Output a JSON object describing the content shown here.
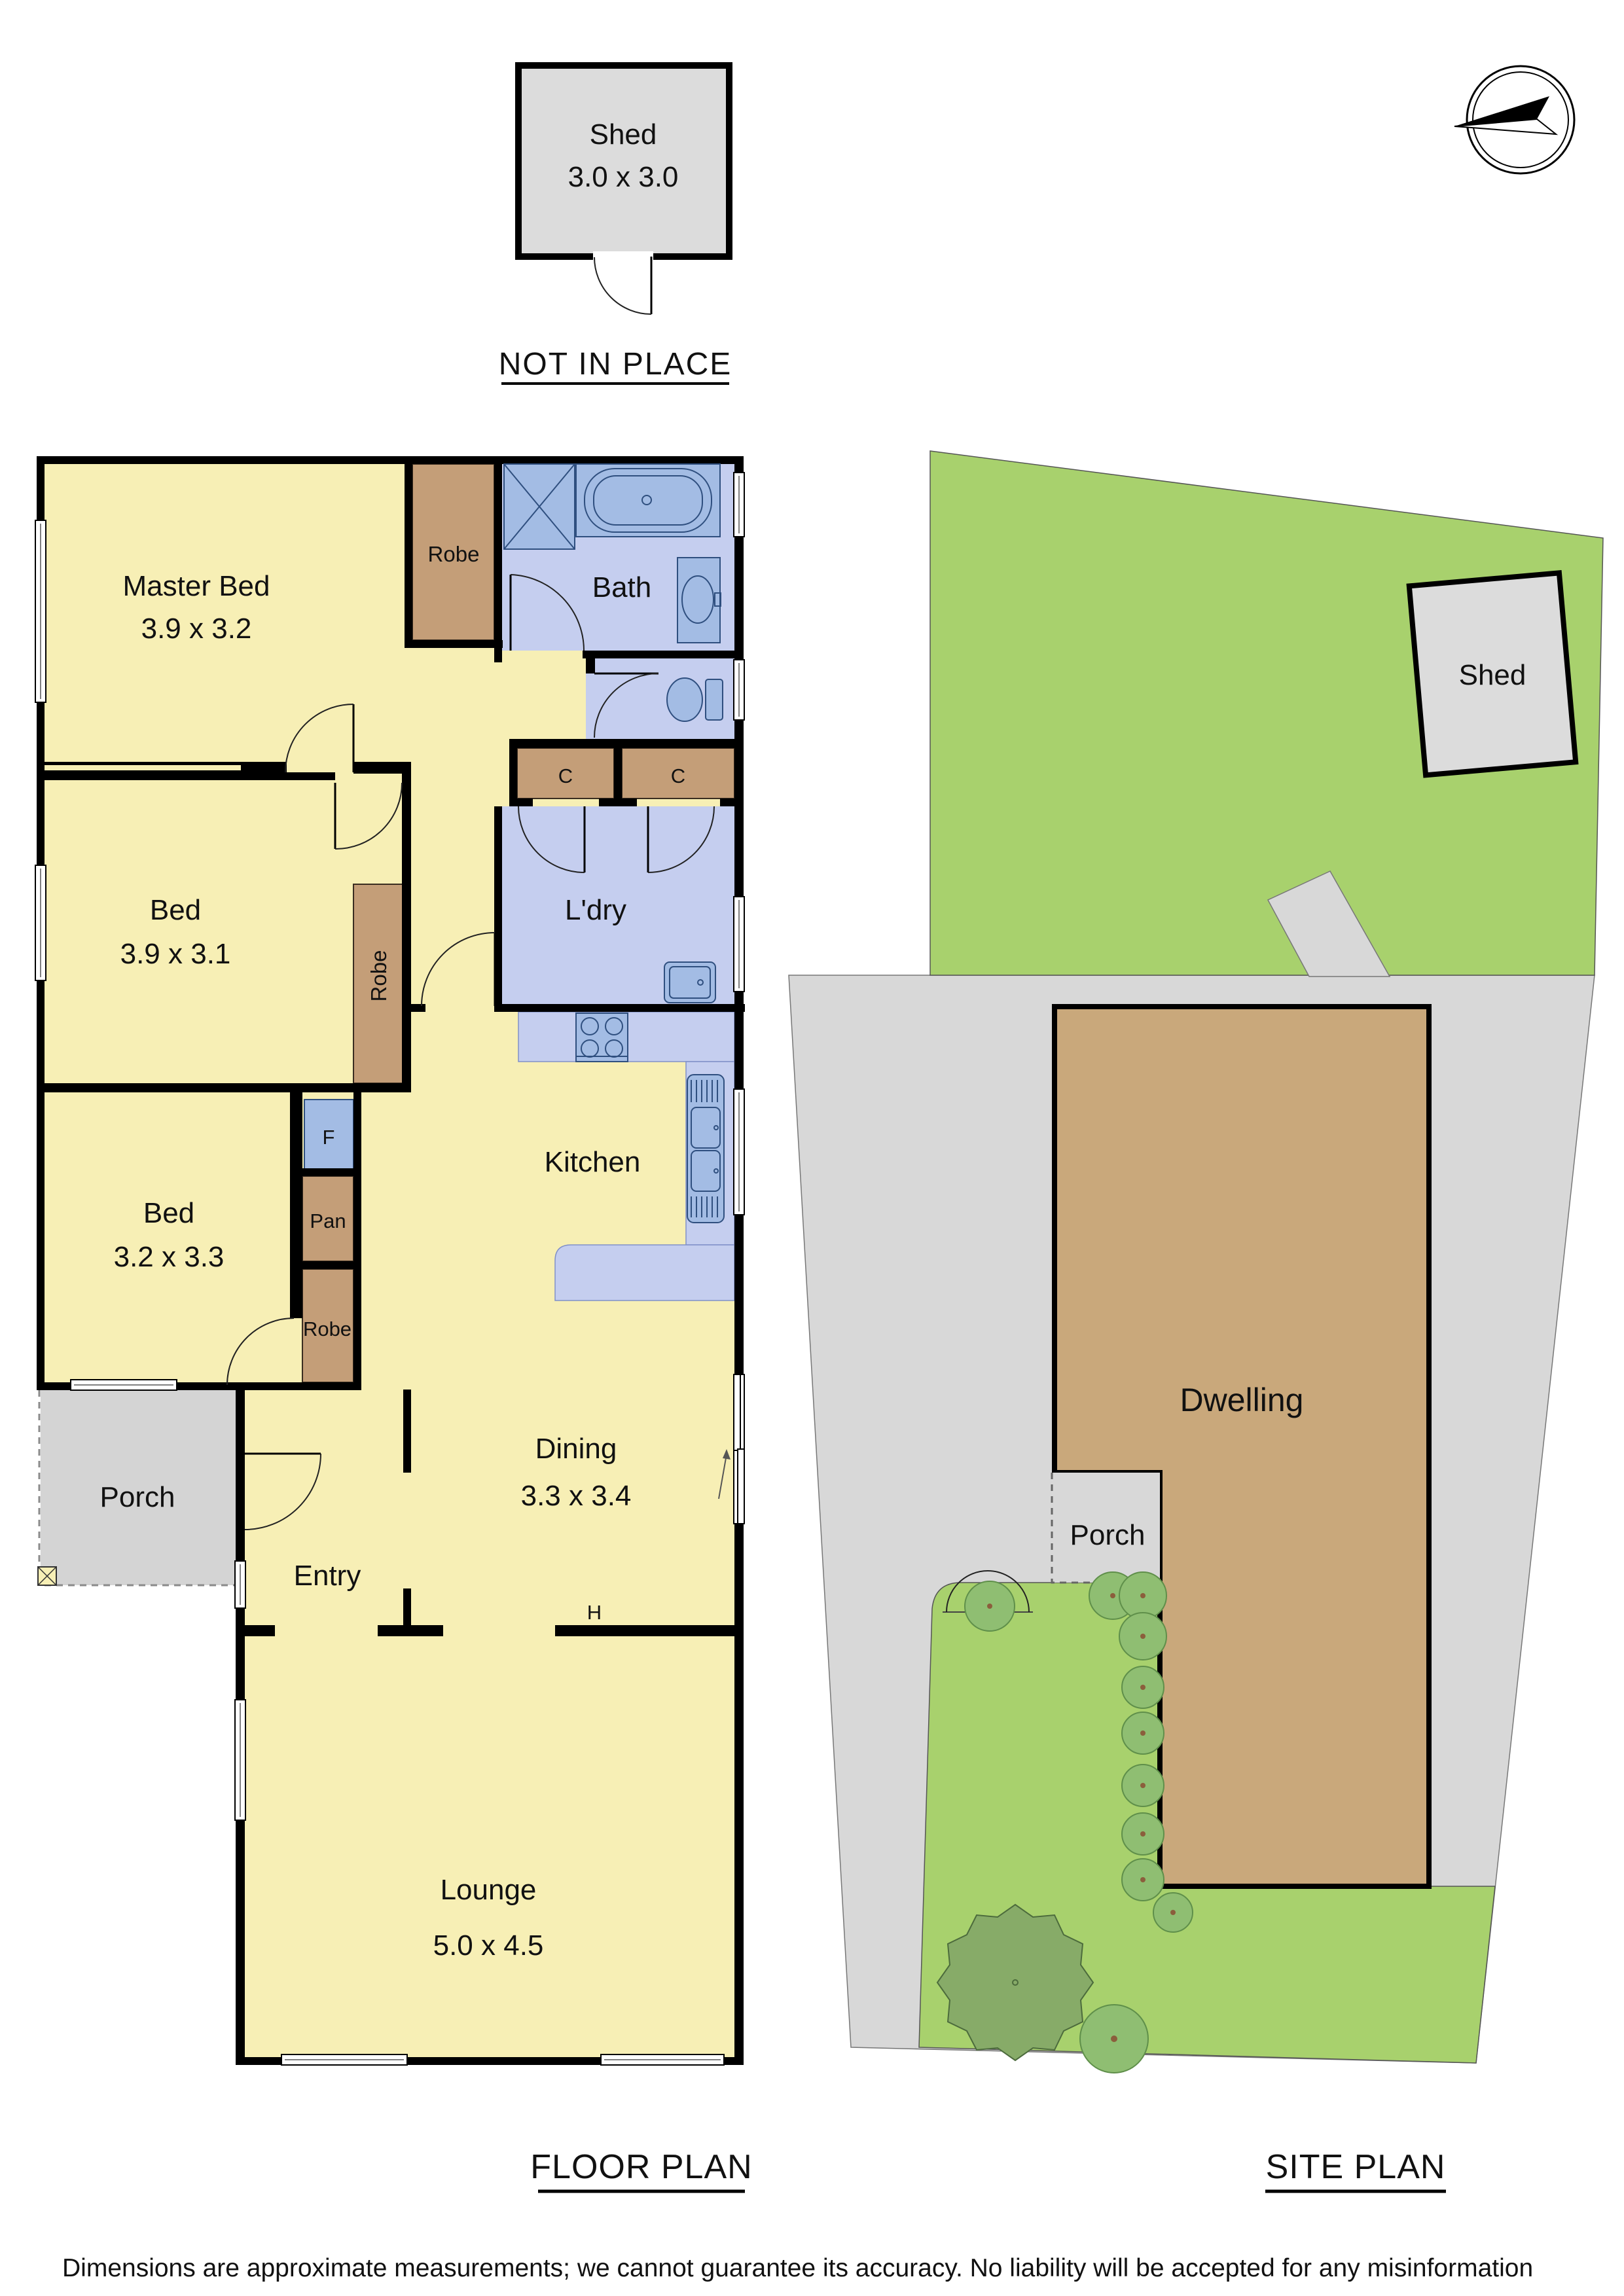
{
  "header": {
    "not_in_place": "NOT IN PLACE"
  },
  "detached_shed": {
    "name": "Shed",
    "dims": "3.0 x 3.0"
  },
  "floor_plan": {
    "section_label": "FLOOR PLAN",
    "rooms": {
      "master_bed": {
        "name": "Master Bed",
        "dims": "3.9 x 3.2"
      },
      "bed_2": {
        "name": "Bed",
        "dims": "3.9 x 3.1"
      },
      "bed_3": {
        "name": "Bed",
        "dims": "3.2 x 3.3"
      },
      "bath": {
        "name": "Bath"
      },
      "laundry": {
        "name": "L'dry"
      },
      "kitchen": {
        "name": "Kitchen"
      },
      "dining": {
        "name": "Dining",
        "dims": "3.3 x 3.4"
      },
      "entry": {
        "name": "Entry"
      },
      "lounge": {
        "name": "Lounge",
        "dims": "5.0 x 4.5"
      },
      "porch": {
        "name": "Porch"
      }
    },
    "storage": {
      "robe_master": "Robe",
      "robe_bed2": "Robe",
      "robe_bed3": "Robe",
      "cupboard_1": "C",
      "cupboard_2": "C",
      "fridge": "F",
      "pantry": "Pan",
      "heater": "H"
    }
  },
  "site_plan": {
    "section_label": "SITE PLAN",
    "labels": {
      "shed": "Shed",
      "dwelling": "Dwelling",
      "porch": "Porch"
    }
  },
  "footer": {
    "disclaimer": "Dimensions are approximate measurements; we cannot guarantee its accuracy. No liability will be accepted for any misinformation"
  },
  "colors": {
    "room_yellow": "#F7EFB5",
    "wet_area_blue": "#C5CEEF",
    "fixture_blue": "#A3BCE4",
    "fixture_outline": "#2F4F7F",
    "robe_brown": "#C49E78",
    "wall_black": "#000000",
    "porch_gray": "#D4D4D4",
    "shed_gray": "#DCDCDC",
    "driveway_gray": "#D8D8D8",
    "lawn_green": "#A8D16D",
    "shrub_green": "#8FBE72",
    "tree_green": "#87AB68",
    "dwelling_tan": "#C9A87B"
  }
}
